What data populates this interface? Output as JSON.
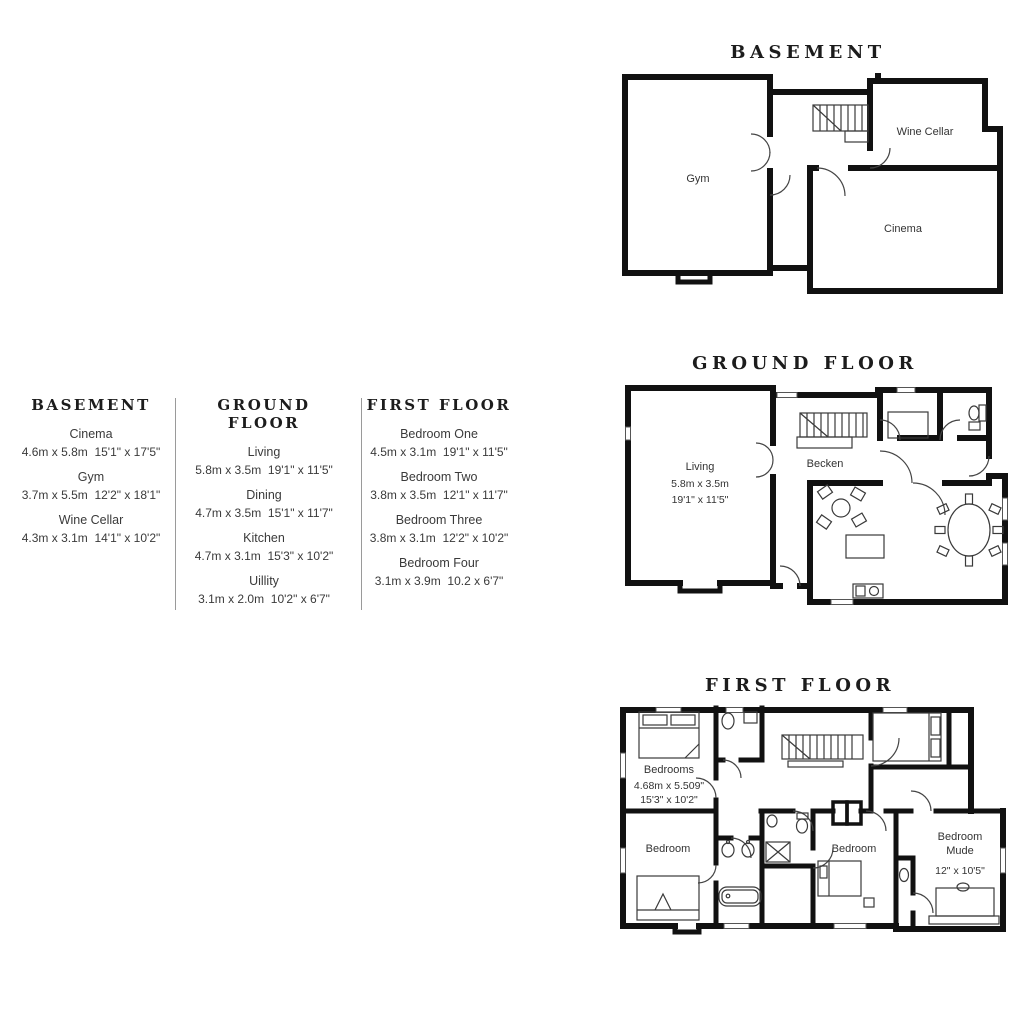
{
  "legend": {
    "columns": [
      {
        "title": "BASEMENT",
        "rooms": [
          {
            "name": "Cinema",
            "metric": "4.6m x 5.8m",
            "imperial": "15'1\" x 17'5\""
          },
          {
            "name": "Gym",
            "metric": "3.7m x 5.5m",
            "imperial": "12'2\" x 18'1\""
          },
          {
            "name": "Wine Cellar",
            "metric": "4.3m x 3.1m",
            "imperial": "14'1\" x 10'2\""
          }
        ]
      },
      {
        "title": "GROUND FLOOR",
        "rooms": [
          {
            "name": "Living",
            "metric": "5.8m x 3.5m",
            "imperial": "19'1\" x 11'5\""
          },
          {
            "name": "Dining",
            "metric": "4.7m x 3.5m",
            "imperial": "15'1\" x 11'7\""
          },
          {
            "name": "Kitchen",
            "metric": "4.7m x 3.1m",
            "imperial": "15'3\" x 10'2\""
          },
          {
            "name": "Uillity",
            "metric": "3.1m x 2.0m",
            "imperial": "10'2\" x 6'7\""
          }
        ]
      },
      {
        "title": "FIRST FLOOR",
        "rooms": [
          {
            "name": "Bedroom One",
            "metric": "4.5m x 3.1m",
            "imperial": "19'1\" x 11'5\""
          },
          {
            "name": "Bedroom Two",
            "metric": "3.8m x 3.5m",
            "imperial": "12'1\" x 11'7\""
          },
          {
            "name": "Bedroom Three",
            "metric": "3.8m x 3.1m",
            "imperial": "12'2\" x 10'2\""
          },
          {
            "name": "Bedroom Four",
            "metric": "3.1m x 3.9m",
            "imperial": "10.2 x 6'7\""
          }
        ]
      }
    ]
  },
  "plans": {
    "basement": {
      "title": "BASEMENT",
      "labels": {
        "gym": "Gym",
        "wine_cellar": "Wine Cellar",
        "cinema": "Cinema"
      }
    },
    "ground": {
      "title": "GROUND FLOOR",
      "labels": {
        "living_name": "Living",
        "living_metric": "5.8m x 3.5m",
        "living_imperial": "19'1\" x 11'5\"",
        "hall": "Becken"
      }
    },
    "first": {
      "title": "FIRST FLOOR",
      "labels": {
        "bedroom1_name": "Bedrooms",
        "bedroom1_metric": "4.68m x 5.509\"",
        "bedroom1_imperial": "15'3\" x 10'2\"",
        "bedroom2": "Bedroom",
        "bedroom3": "Bedroom",
        "master_name": "Bedroom",
        "master_sub": "Mude",
        "master_dims": "12\" x 10'5\""
      }
    }
  }
}
